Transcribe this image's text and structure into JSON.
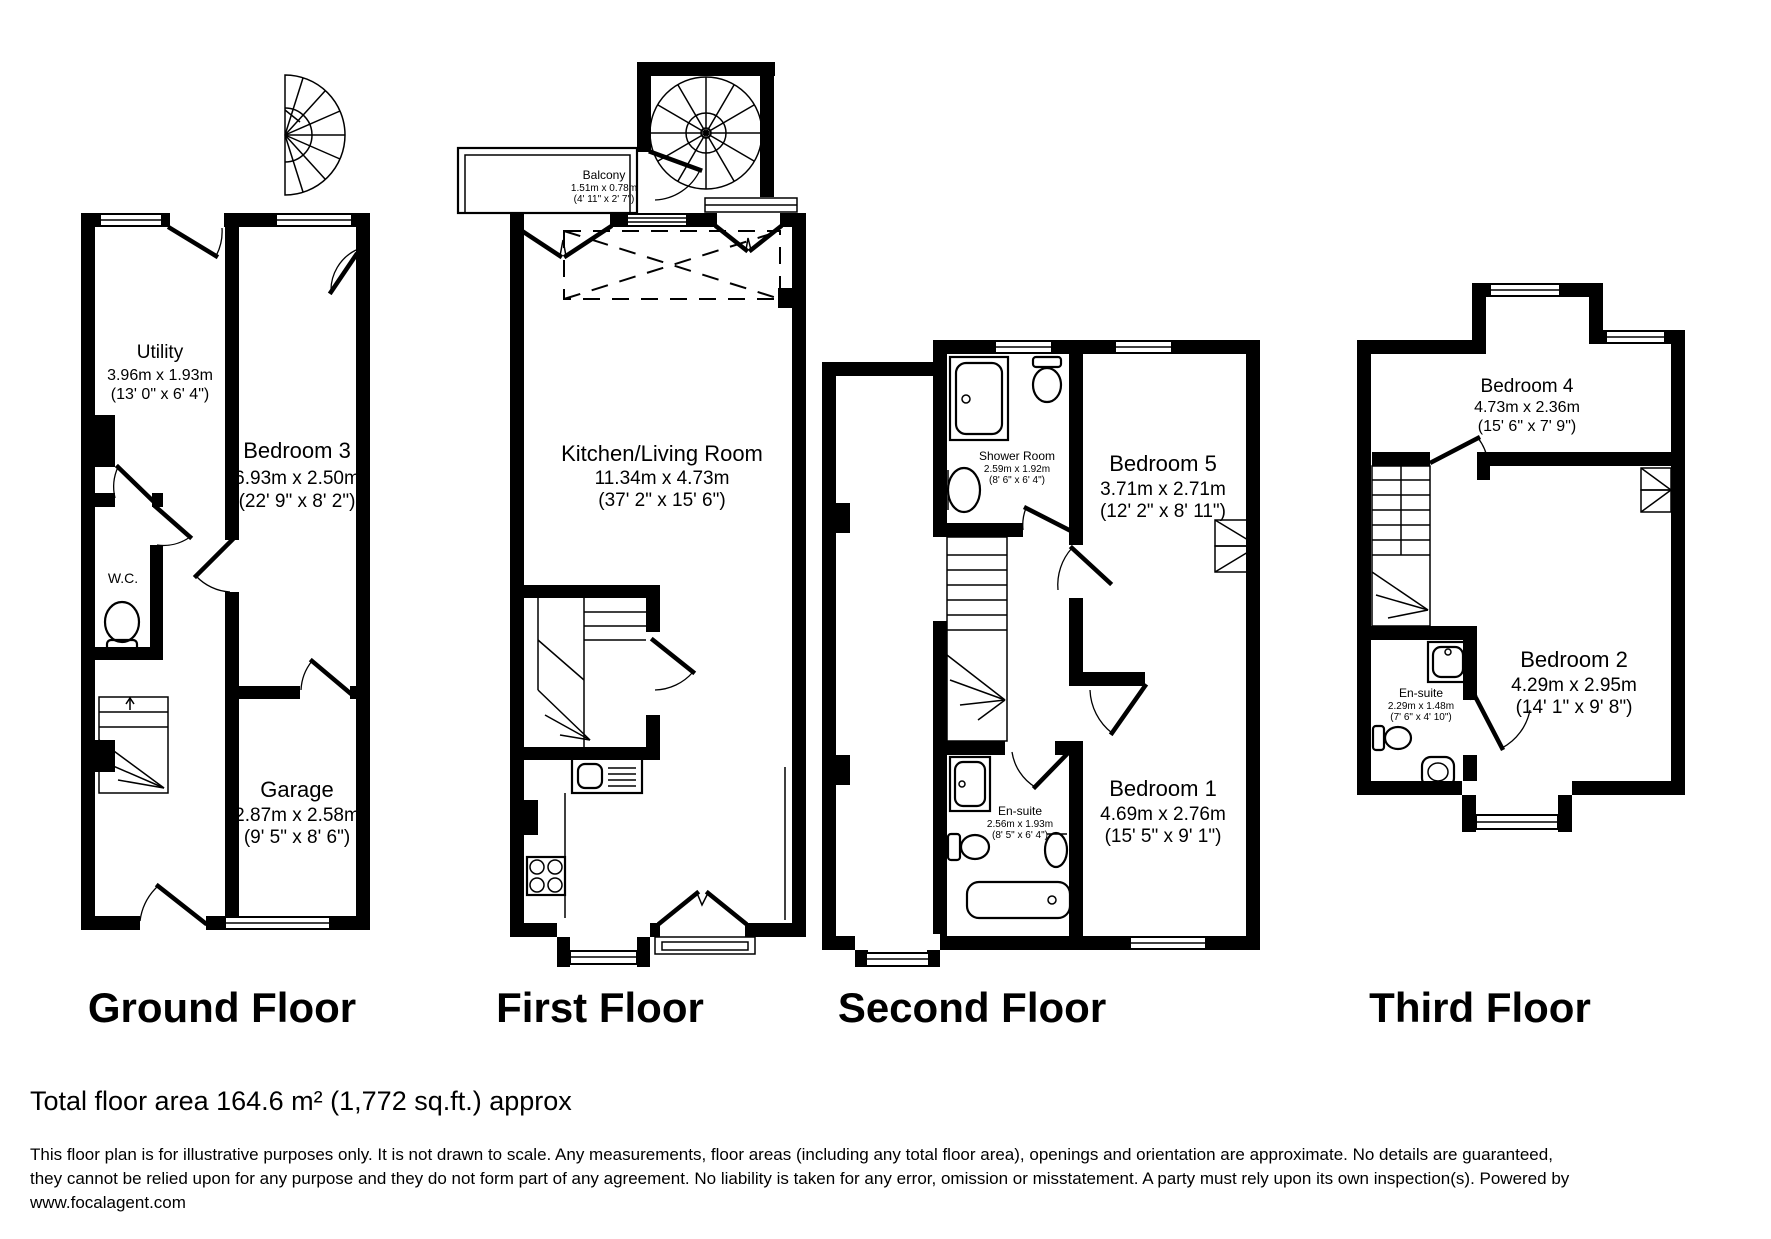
{
  "floors": [
    {
      "title": "Ground Floor",
      "rooms": [
        {
          "name": "Utility",
          "dims_m": "3.96m x 1.93m",
          "dims_ft": "(13' 0\" x 6' 4\")"
        },
        {
          "name": "Bedroom 3",
          "dims_m": "6.93m x 2.50m",
          "dims_ft": "(22' 9\" x 8' 2\")"
        },
        {
          "name": "W.C.",
          "dims_m": "",
          "dims_ft": ""
        },
        {
          "name": "Garage",
          "dims_m": "2.87m x 2.58m",
          "dims_ft": "(9' 5\" x 8' 6\")"
        }
      ]
    },
    {
      "title": "First Floor",
      "rooms": [
        {
          "name": "Balcony",
          "dims_m": "1.51m x 0.78m",
          "dims_ft": "(4' 11\" x 2' 7\")"
        },
        {
          "name": "Kitchen/Living Room",
          "dims_m": "11.34m x 4.73m",
          "dims_ft": "(37' 2\" x 15' 6\")"
        }
      ]
    },
    {
      "title": "Second Floor",
      "rooms": [
        {
          "name": "Shower Room",
          "dims_m": "2.59m x 1.92m",
          "dims_ft": "(8' 6\" x 6' 4\")"
        },
        {
          "name": "Bedroom 5",
          "dims_m": "3.71m x 2.71m",
          "dims_ft": "(12' 2\" x 8' 11\")"
        },
        {
          "name": "En-suite",
          "dims_m": "2.56m x 1.93m",
          "dims_ft": "(8' 5\" x 6' 4\")"
        },
        {
          "name": "Bedroom 1",
          "dims_m": "4.69m x 2.76m",
          "dims_ft": "(15' 5\" x 9' 1\")"
        }
      ]
    },
    {
      "title": "Third Floor",
      "rooms": [
        {
          "name": "Bedroom 4",
          "dims_m": "4.73m x 2.36m",
          "dims_ft": "(15' 6\" x 7' 9\")"
        },
        {
          "name": "En-suite",
          "dims_m": "2.29m x 1.48m",
          "dims_ft": "(7' 6\" x 4' 10\")"
        },
        {
          "name": "Bedroom 2",
          "dims_m": "4.29m x 2.95m",
          "dims_ft": "(14' 1\" x 9' 8\")"
        }
      ]
    }
  ],
  "footer": {
    "total_area": "Total floor area 164.6 m² (1,772 sq.ft.) approx",
    "disclaimer_line1": "This floor plan is for illustrative purposes only. It is not drawn to scale. Any measurements, floor areas (including any total floor area), openings and orientation are approximate. No details are guaranteed,",
    "disclaimer_line2": "they cannot be relied upon for any purpose and they do not form part of any agreement. No liability is taken for any error, omission or misstatement. A party must rely upon its own inspection(s). Powered by",
    "disclaimer_line3": "www.focalagent.com"
  },
  "colors": {
    "wall": "#000000",
    "background": "#ffffff"
  }
}
